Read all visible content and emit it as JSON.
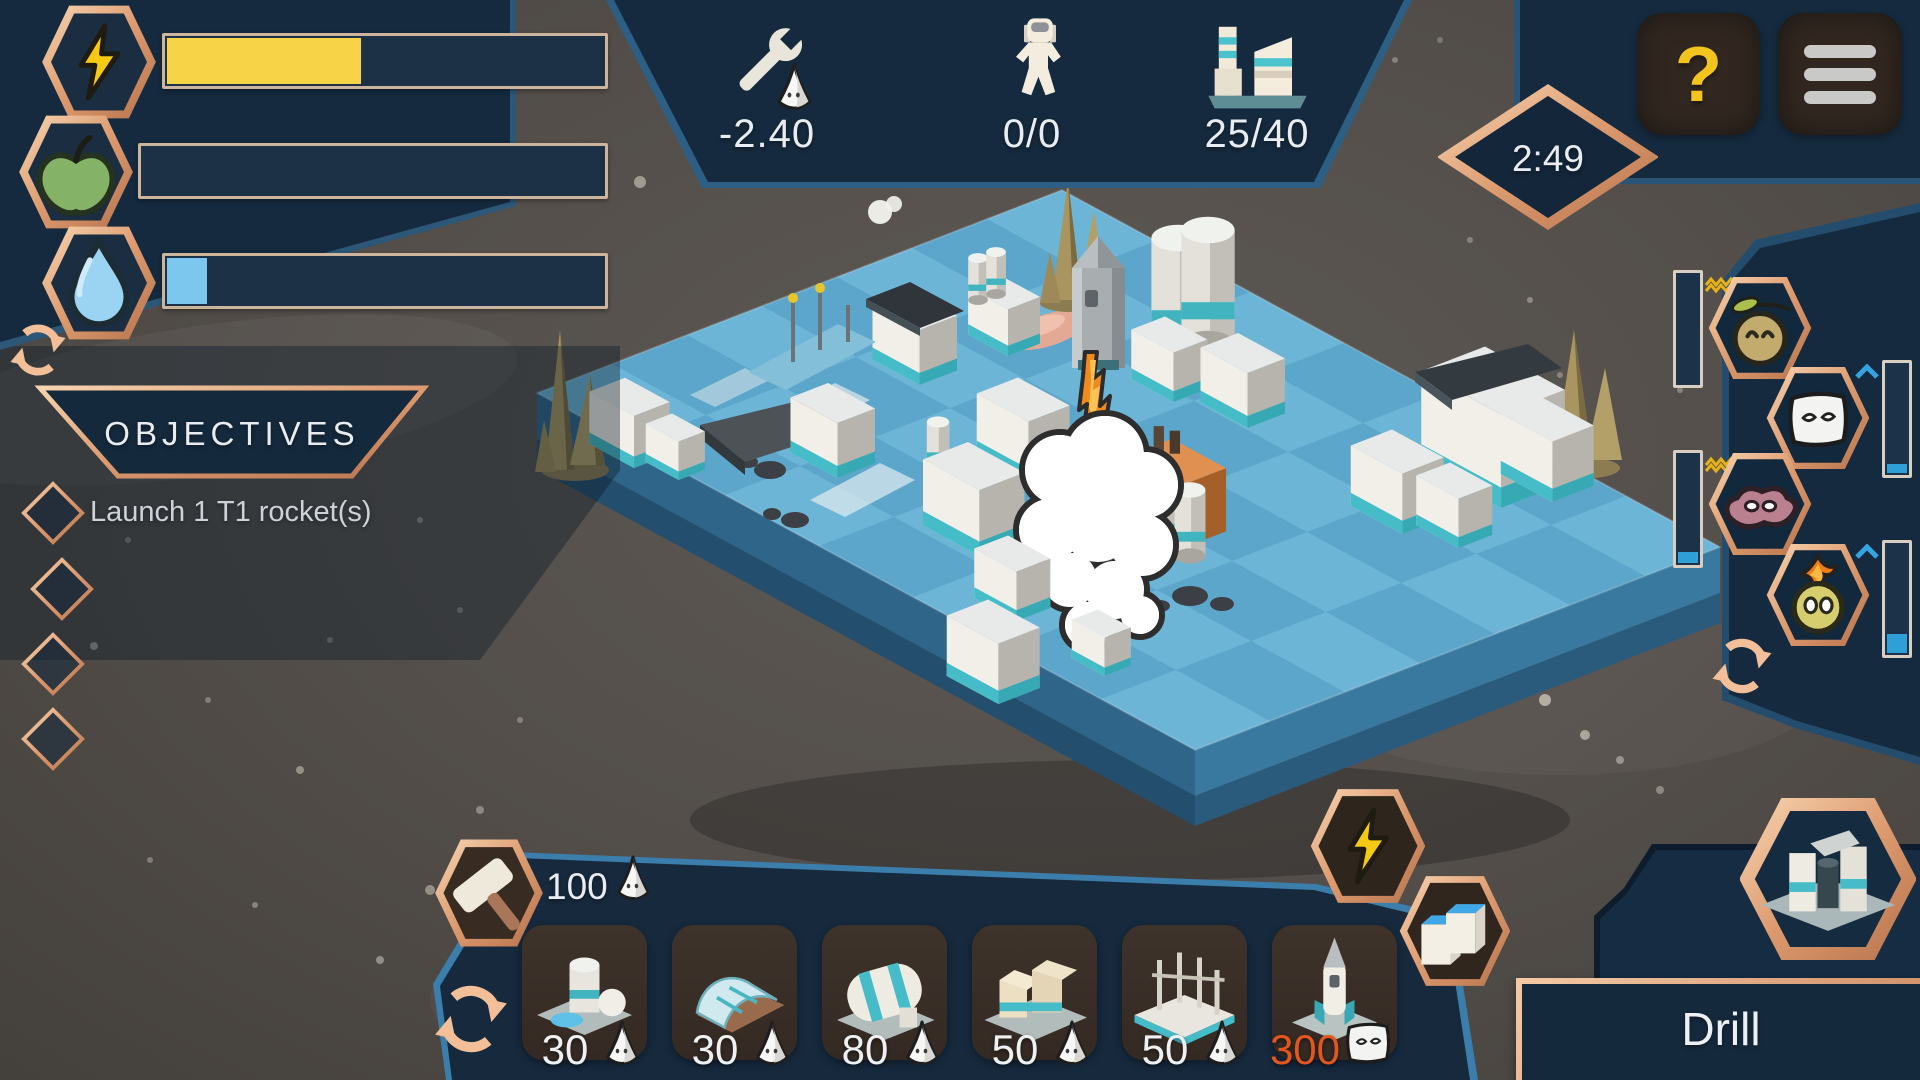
{
  "hud": {
    "stats": {
      "maintenance": "-2.40",
      "colonists": "0/0",
      "buildings": "25/40"
    },
    "timer": "2:49",
    "help_label": "?"
  },
  "resources": [
    {
      "name": "energy",
      "icon": "lightning-bolt-icon",
      "fill_style": "width:44%"
    },
    {
      "name": "food",
      "icon": "apple-icon",
      "fill_style": "width:0%"
    },
    {
      "name": "water",
      "icon": "water-drop-icon",
      "fill_style": "width:9%"
    }
  ],
  "objectives": {
    "title": "OBJECTIVES",
    "items": [
      {
        "label": "Launch 1 T1 rocket(s)"
      },
      {
        "label": ""
      },
      {
        "label": ""
      },
      {
        "label": ""
      }
    ]
  },
  "moods": {
    "gauges": [
      {
        "species": "leaf-creature",
        "fill_style": "height:0%"
      },
      {
        "species": "white-creature",
        "fill_style": "height:8%"
      },
      {
        "species": "meat-creature",
        "fill_style": "height:10%"
      },
      {
        "species": "fire-creature",
        "fill_style": "height:17%"
      }
    ]
  },
  "build": {
    "currency": "100",
    "cards": [
      {
        "cost": "30",
        "badge": "mound-creature-icon",
        "building": "habitat-dome"
      },
      {
        "cost": "30",
        "badge": "mound-creature-icon",
        "building": "greenhouse"
      },
      {
        "cost": "80",
        "badge": "mound-creature-icon",
        "building": "storage-tank"
      },
      {
        "cost": "50",
        "badge": "mound-creature-icon",
        "building": "factory"
      },
      {
        "cost": "50",
        "badge": "mound-creature-icon",
        "building": "scaffold"
      },
      {
        "cost": "300",
        "badge": "white-creature-icon",
        "building": "rocket",
        "alt": true
      }
    ],
    "selection": "Drill"
  },
  "colors": {
    "copper": "#dd9a6f",
    "panel_navy": "#152a3e",
    "energy_yellow": "#f7d348",
    "water_blue": "#7cc7ee",
    "gauge_blue": "#2f9fd8",
    "alt_cost_orange": "#e2571d",
    "tile_blue": "#64adcf"
  }
}
